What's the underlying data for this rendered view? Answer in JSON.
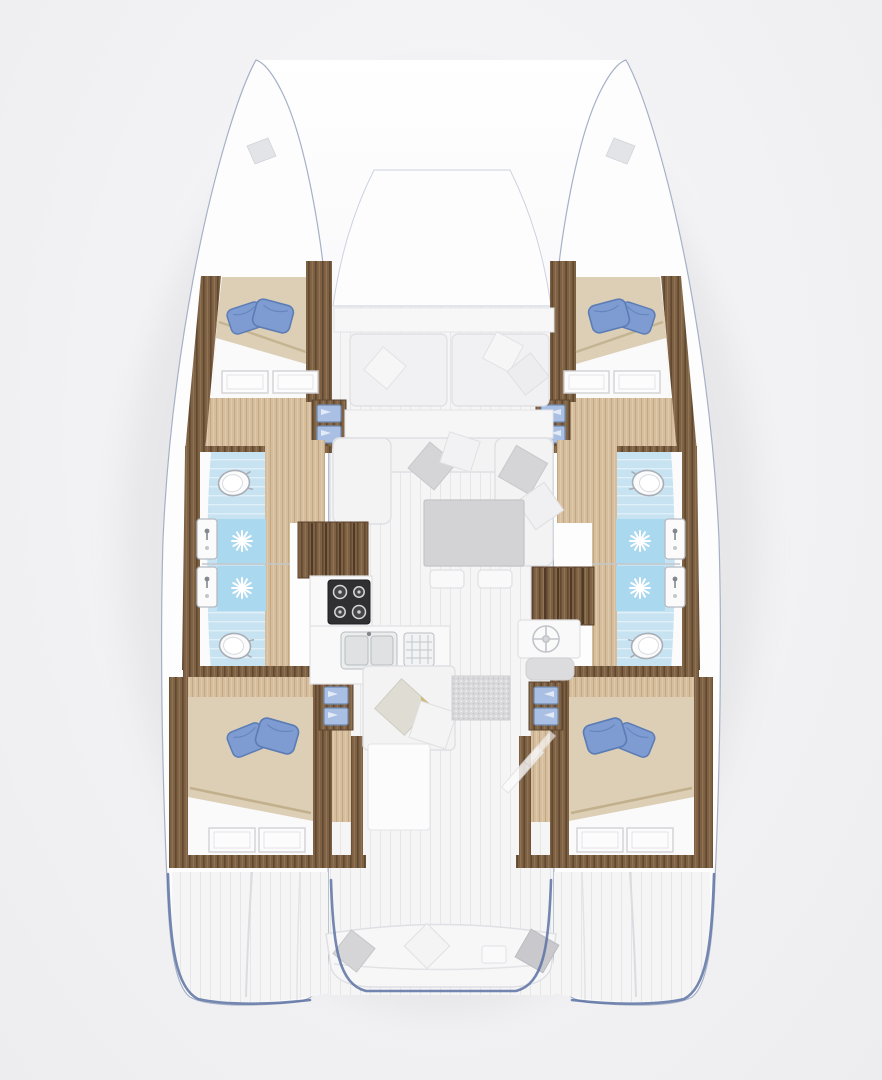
{
  "scene": {
    "kind": "catamaran-interior-floor-plan",
    "orientation": "bow-up",
    "background": "#f2f2f4",
    "inventory": {
      "hulls": 2,
      "double_cabins": 4,
      "bathrooms": 4,
      "showers": 4,
      "toilets": 4,
      "bath_sinks": 4,
      "galley_burners": 4,
      "galley_sinks": 2,
      "companionway_stairs": 2,
      "saloon_tables": 1,
      "cockpit_benches": 1,
      "deck_hatches": 2,
      "blue_pillows_per_bed": 2
    },
    "palette": {
      "bg": "#f2f2f4",
      "hull-fill": "#fdfdfe",
      "hull-line": "#a6b0c6",
      "trim-blue": "#5c72a2",
      "wood-dark": "#7e6143",
      "wood-light": "#d6be9c",
      "bed-beige": "#dccfb6",
      "bed-fold": "#c2b08d",
      "pillow-blue": "#7e9cd1",
      "pillow-blue-dark": "#5c7cb5",
      "cabinet-blue": "#a9c0e4",
      "tile-blue": "#c7e3f2",
      "shower-blue": "#a9d8ef",
      "fixture-white": "#fbfbfc",
      "fixture-line": "#a9aeb6",
      "floor-plank": "#f5f5f6",
      "sofa-fill": "#f3f3f4",
      "sofa-line": "#dfe0e3",
      "pillow-gray": "#d5d5d8",
      "table-gray": "#d3d3d6",
      "stove-black": "#303032",
      "rug-gray": "#d9d9dc",
      "gold-accent": "#c9b768",
      "shadow": "#e7e7ea"
    }
  }
}
